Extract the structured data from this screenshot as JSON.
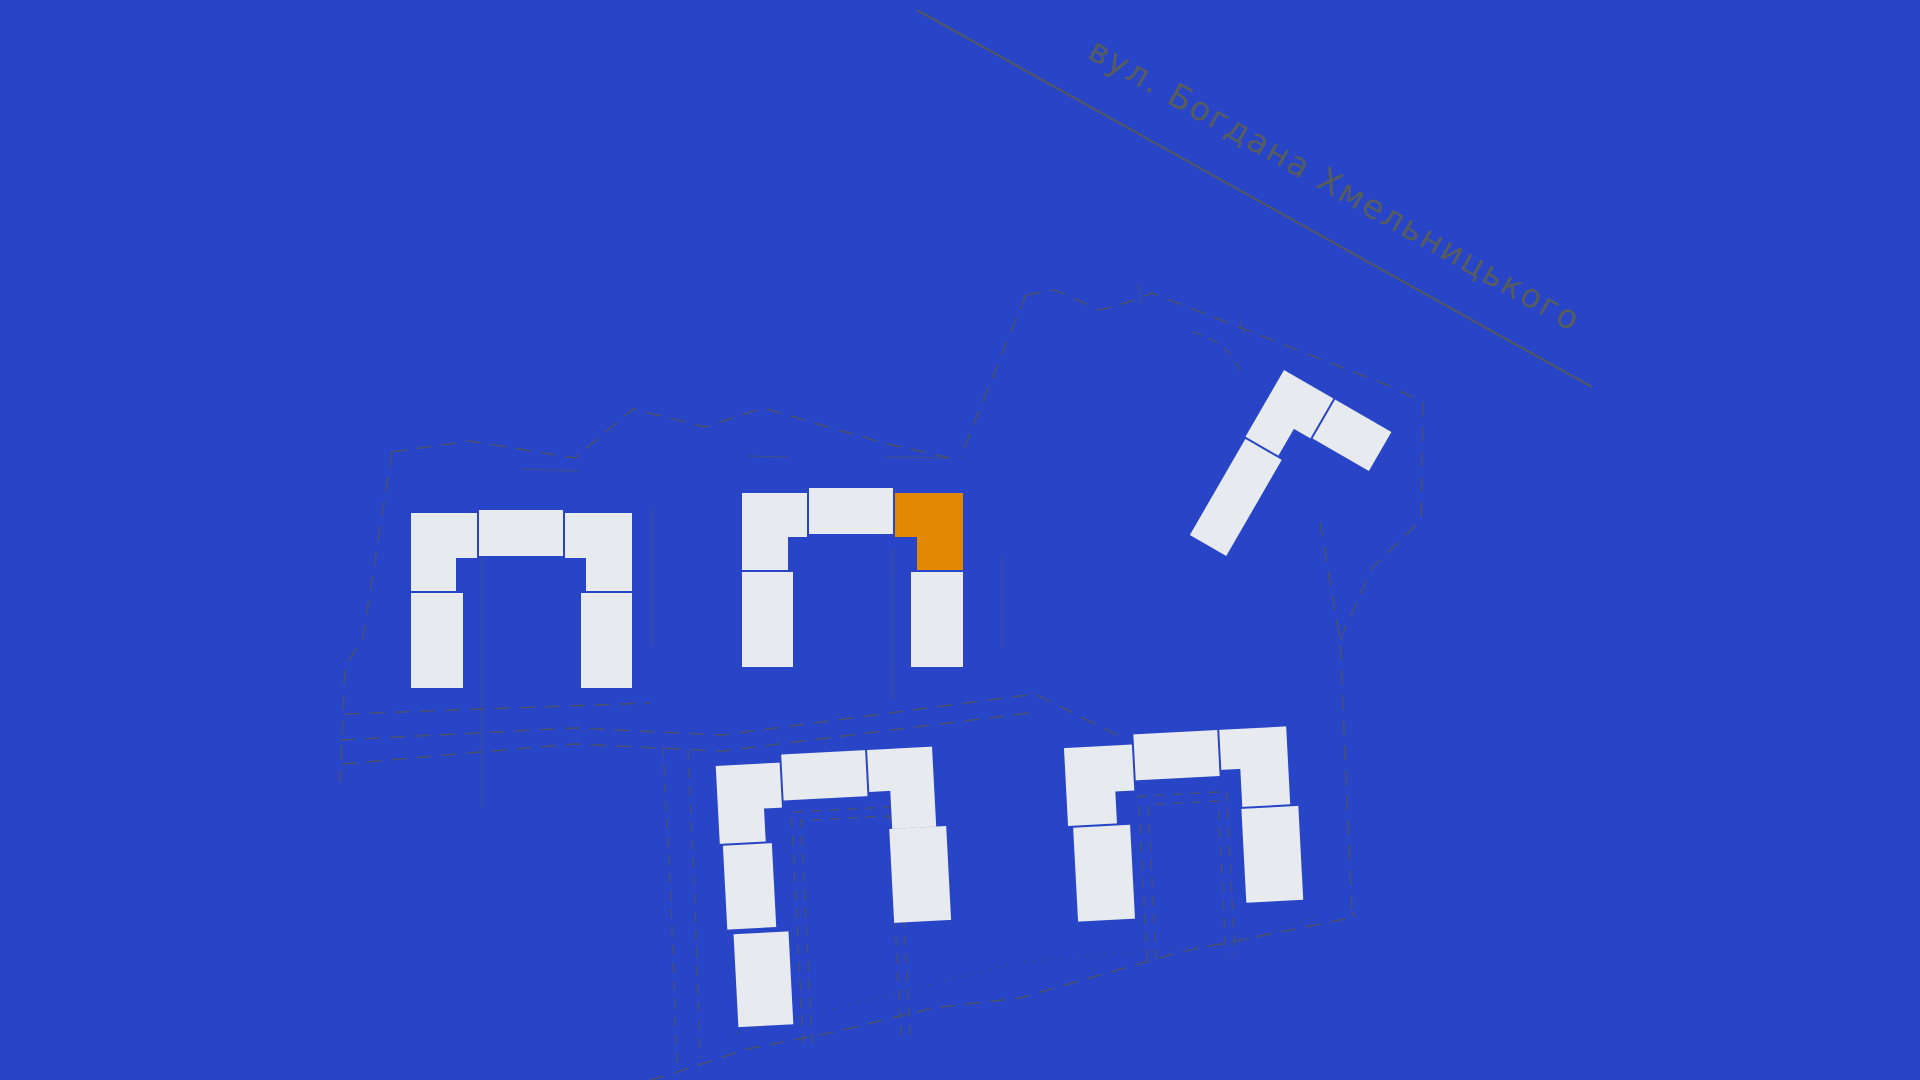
{
  "page": {
    "kind": "residential-complex-site-plan",
    "language": "uk"
  },
  "street": {
    "label": "вул. Богдана Хмельницького"
  },
  "site": {
    "selected_block": {
      "cluster": "central-u-block",
      "position": "north-east-corner",
      "state": "highlighted-orange"
    },
    "clusters": [
      {
        "name": "west-u-block",
        "blocks": 5,
        "highlighted": false
      },
      {
        "name": "central-u-block",
        "blocks": 5,
        "highlighted": true
      },
      {
        "name": "north-east-l-block",
        "blocks": 3,
        "highlighted": false
      },
      {
        "name": "south-central-u-block",
        "blocks": 6,
        "highlighted": false
      },
      {
        "name": "south-east-u-block",
        "blocks": 5,
        "highlighted": false
      }
    ]
  },
  "colors": {
    "background": "#2845C7",
    "building": "#E7EAEE",
    "highlight": "#E38803",
    "boundary": "#585847",
    "street_text": "#5D6052"
  }
}
